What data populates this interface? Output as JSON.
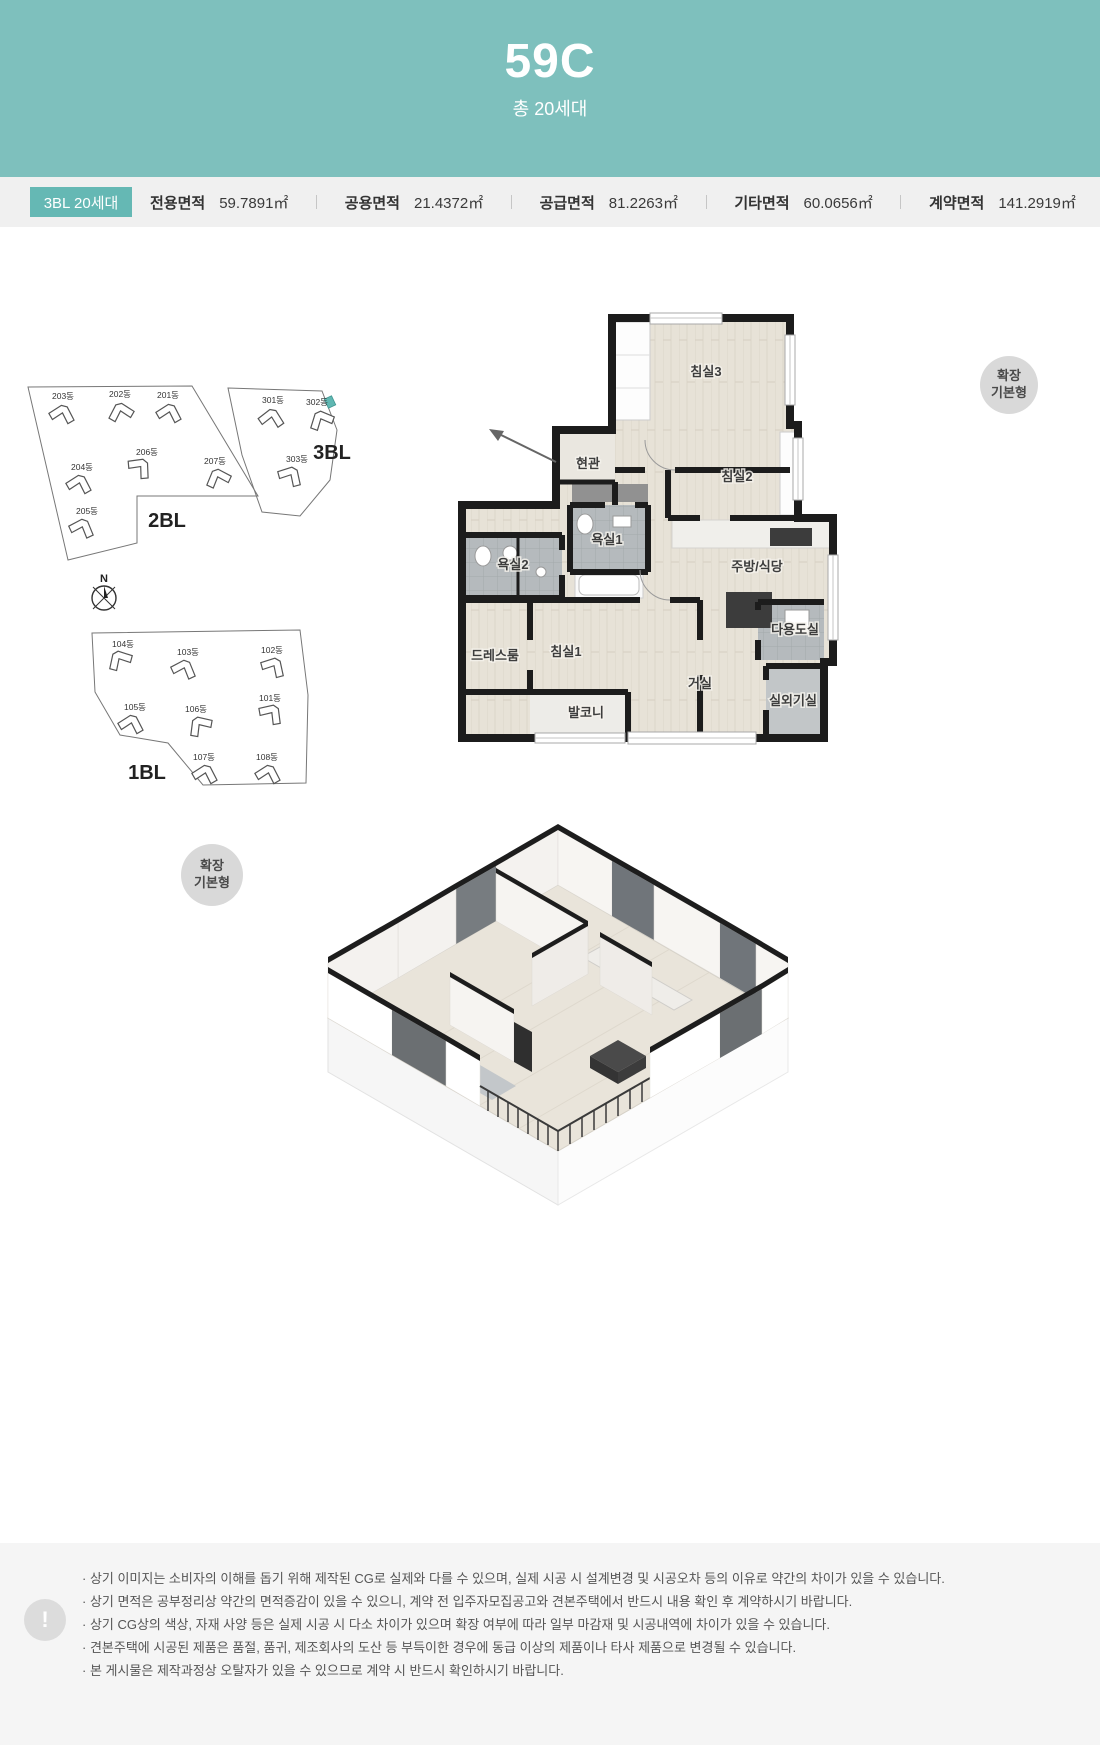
{
  "header": {
    "unit_type": "59C",
    "subtitle": "총 20세대"
  },
  "info_bar": {
    "badge": "3BL 20세대",
    "areas": [
      {
        "label": "전용면적",
        "value": "59.7891㎡"
      },
      {
        "label": "공용면적",
        "value": "21.4372㎡"
      },
      {
        "label": "공급면적",
        "value": "81.2263㎡"
      },
      {
        "label": "기타면적",
        "value": "60.0656㎡"
      },
      {
        "label": "계약면적",
        "value": "141.2919㎡"
      }
    ]
  },
  "site_plan": {
    "compass": "N",
    "blocks": [
      {
        "name": "2BL",
        "buildings": [
          "203동",
          "202동",
          "201동",
          "206동",
          "204동",
          "207동",
          "205동"
        ]
      },
      {
        "name": "3BL",
        "buildings": [
          "301동",
          "302동",
          "303동"
        ],
        "highlighted_building": "302동"
      },
      {
        "name": "1BL",
        "buildings": [
          "104동",
          "103동",
          "102동",
          "105동",
          "106동",
          "101동",
          "107동",
          "108동"
        ]
      }
    ]
  },
  "plan2d": {
    "badge_line1": "확장",
    "badge_line2": "기본형",
    "rooms": [
      "침실3",
      "현관",
      "침실2",
      "욕실1",
      "욕실2",
      "주방/식당",
      "다용도실",
      "드레스룸",
      "침실1",
      "거실",
      "발코니",
      "실외기실"
    ]
  },
  "plan3d": {
    "badge_line1": "확장",
    "badge_line2": "기본형"
  },
  "footer": {
    "icon_char": "!",
    "notes": [
      "· 상기 이미지는 소비자의 이해를 돕기 위해 제작된 CG로 실제와 다를 수 있으며, 실제 시공 시 설계변경 및 시공오차 등의 이유로 약간의 차이가 있을 수 있습니다.",
      "· 상기 면적은 공부정리상 약간의 면적증감이 있을 수 있으니, 계약 전 입주자모집공고와 견본주택에서 반드시 내용 확인 후 계약하시기 바랍니다.",
      "· 상기 CG상의 색상, 자재 사양 등은 실제 시공 시 다소 차이가 있으며 확장 여부에 따라 일부 마감재 및 시공내역에 차이가 있을 수 있습니다.",
      "· 견본주택에 시공된 제품은 품절, 품귀, 제조회사의 도산 등 부득이한 경우에 동급 이상의 제품이나 타사 제품으로 변경될 수 있습니다.",
      "· 본 게시물은 제작과정상 오탈자가 있을 수 있으므로 계약 시 반드시 확인하시기 바랍니다."
    ]
  },
  "colors": {
    "header_teal": "#7ec0bd",
    "badge_teal": "#65b8b4",
    "highlight_unit_teal": "#5fb7b2",
    "wall_black": "#1c1c1c",
    "footer_bg": "#f5f5f5"
  }
}
